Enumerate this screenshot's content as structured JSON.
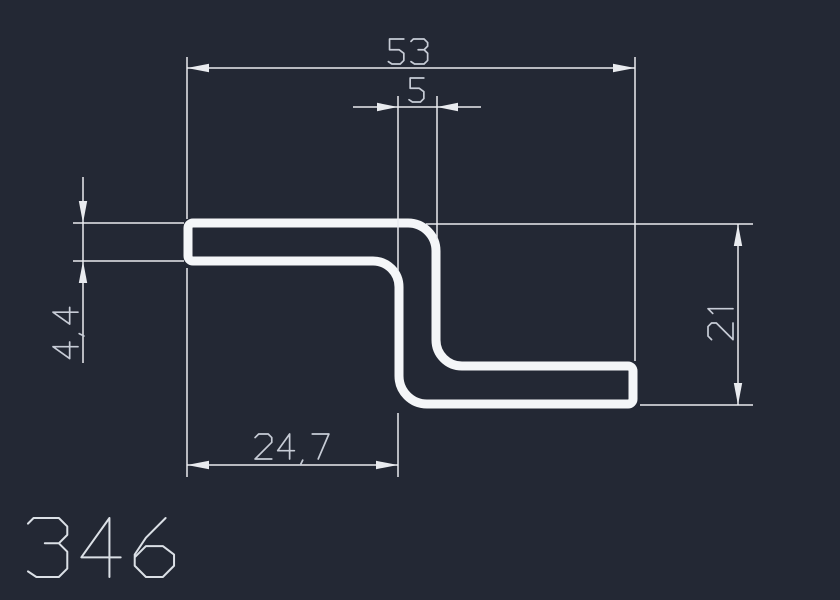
{
  "drawing": {
    "number": "346"
  },
  "dimensions": {
    "overall_width": "53",
    "web_width": "5",
    "material_thickness": "4,4",
    "height_right": "21",
    "bottom_width_left": "24,7"
  },
  "colors": {
    "background": "#232834",
    "profile_line": "#f4f6f8",
    "dimension_line": "#e9ebef",
    "dimension_text": "#c7ccd6",
    "label_text": "#dbe0e6"
  }
}
